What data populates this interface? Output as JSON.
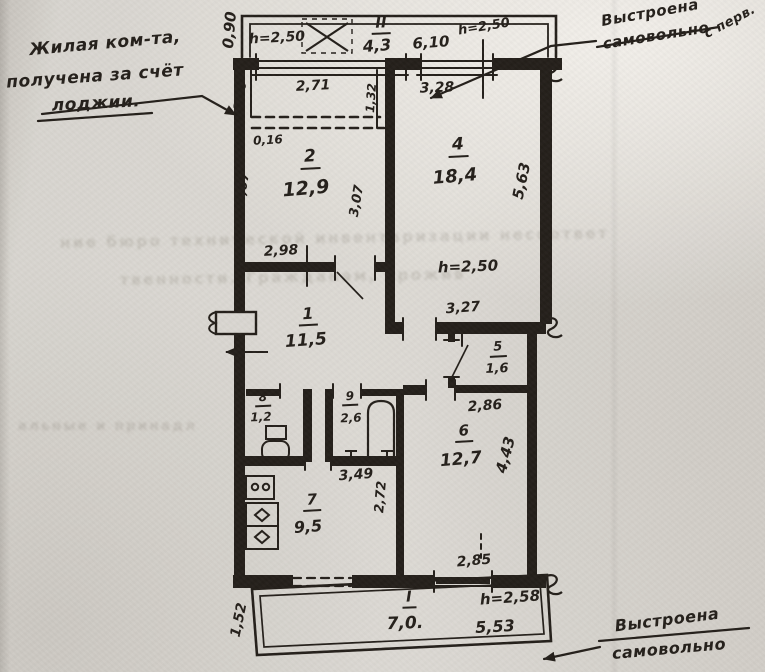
{
  "paper_color": "#dad7d1",
  "ink_color": "#241f1a",
  "rooms": [
    {
      "number": "II",
      "area": "4,3"
    },
    {
      "number": "2",
      "area": "12,9"
    },
    {
      "number": "4",
      "area": "18,4"
    },
    {
      "number": "1",
      "area": "11,5"
    },
    {
      "number": "5",
      "area": "1,6"
    },
    {
      "number": "8",
      "area": "1,2"
    },
    {
      "number": "9",
      "area": "2,6"
    },
    {
      "number": "6",
      "area": "12,7"
    },
    {
      "number": "7",
      "area": "9,5"
    },
    {
      "number": "I",
      "area": "7,0."
    }
  ],
  "labels": [
    {
      "name": "height-loggia",
      "text": "h=2,50",
      "x": 277,
      "y": 38,
      "size": 14,
      "rot": -3
    },
    {
      "name": "room-II-number",
      "text": "II",
      "x": 381,
      "y": 25,
      "size": 15,
      "rot": -2,
      "underline": true
    },
    {
      "name": "room-II-area",
      "text": "4,3",
      "x": 377,
      "y": 46,
      "size": 16,
      "rot": -4
    },
    {
      "name": "dim-6-10",
      "text": "6,10",
      "x": 431,
      "y": 43,
      "size": 15,
      "rot": -4
    },
    {
      "name": "height-loggia-right",
      "text": "h=2,50",
      "x": 484,
      "y": 27,
      "size": 13,
      "rot": -9
    },
    {
      "name": "dim-0-90",
      "text": "0,90",
      "x": 230,
      "y": 30,
      "size": 15,
      "rot": -85
    },
    {
      "name": "dim-2-71",
      "text": "2,71",
      "x": 313,
      "y": 86,
      "size": 14,
      "rot": -3
    },
    {
      "name": "dim-1-80",
      "text": "1,80",
      "x": 240,
      "y": 96,
      "size": 12,
      "rot": -80
    },
    {
      "name": "dim-1-32",
      "text": "1,32",
      "x": 371,
      "y": 98,
      "size": 12,
      "rot": -86
    },
    {
      "name": "dim-0-16",
      "text": "0,16",
      "x": 268,
      "y": 140,
      "size": 12,
      "rot": -3
    },
    {
      "name": "room-2-number",
      "text": "2",
      "x": 310,
      "y": 159,
      "size": 17,
      "rot": -3,
      "underline": true
    },
    {
      "name": "room-2-area",
      "text": "12,9",
      "x": 306,
      "y": 189,
      "size": 19,
      "rot": -5
    },
    {
      "name": "dim-3-07-left",
      "text": "3,07",
      "x": 243,
      "y": 188,
      "size": 13,
      "rot": -80
    },
    {
      "name": "dim-3-07-right",
      "text": "3,07",
      "x": 357,
      "y": 201,
      "size": 13,
      "rot": -80
    },
    {
      "name": "dim-2-98",
      "text": "2,98",
      "x": 281,
      "y": 251,
      "size": 14,
      "rot": -3
    },
    {
      "name": "dim-3-28",
      "text": "3,28",
      "x": 437,
      "y": 88,
      "size": 14,
      "rot": -2
    },
    {
      "name": "room-4-number",
      "text": "4",
      "x": 458,
      "y": 147,
      "size": 17,
      "rot": -3,
      "underline": true
    },
    {
      "name": "room-4-area",
      "text": "18,4",
      "x": 455,
      "y": 177,
      "size": 18,
      "rot": -5
    },
    {
      "name": "dim-5-63",
      "text": "5,63",
      "x": 522,
      "y": 181,
      "size": 15,
      "rot": -78
    },
    {
      "name": "height-room-4",
      "text": "h=2,50",
      "x": 468,
      "y": 267,
      "size": 15,
      "rot": -2
    },
    {
      "name": "dim-3-27",
      "text": "3,27",
      "x": 463,
      "y": 308,
      "size": 14,
      "rot": -4
    },
    {
      "name": "room-1-number",
      "text": "1",
      "x": 308,
      "y": 316,
      "size": 16,
      "rot": -3,
      "underline": true
    },
    {
      "name": "room-1-area",
      "text": "11,5",
      "x": 306,
      "y": 341,
      "size": 17,
      "rot": -4
    },
    {
      "name": "room-5-number",
      "text": "5",
      "x": 498,
      "y": 349,
      "size": 13,
      "rot": -3,
      "underline": true
    },
    {
      "name": "room-5-area",
      "text": "1,6",
      "x": 497,
      "y": 369,
      "size": 13,
      "rot": -2
    },
    {
      "name": "dim-2-86",
      "text": "2,86",
      "x": 485,
      "y": 406,
      "size": 14,
      "rot": -4
    },
    {
      "name": "room-8-number",
      "text": "8",
      "x": 263,
      "y": 399,
      "size": 12,
      "rot": -3,
      "underline": true
    },
    {
      "name": "room-8-area",
      "text": "1,2",
      "x": 261,
      "y": 417,
      "size": 12,
      "rot": -2
    },
    {
      "name": "room-9-number",
      "text": "9",
      "x": 350,
      "y": 398,
      "size": 12,
      "rot": -3,
      "underline": true
    },
    {
      "name": "room-9-area",
      "text": "2,6",
      "x": 351,
      "y": 418,
      "size": 12,
      "rot": -2
    },
    {
      "name": "dim-3-49",
      "text": "3,49",
      "x": 356,
      "y": 475,
      "size": 14,
      "rot": -4
    },
    {
      "name": "room-6-number",
      "text": "6",
      "x": 464,
      "y": 433,
      "size": 15,
      "rot": -3,
      "underline": true
    },
    {
      "name": "room-6-area",
      "text": "12,7",
      "x": 461,
      "y": 460,
      "size": 17,
      "rot": -5
    },
    {
      "name": "dim-4-43",
      "text": "4,43",
      "x": 506,
      "y": 455,
      "size": 15,
      "rot": -75
    },
    {
      "name": "dim-2-85",
      "text": "2,85",
      "x": 474,
      "y": 561,
      "size": 14,
      "rot": -5
    },
    {
      "name": "room-7-number",
      "text": "7",
      "x": 312,
      "y": 502,
      "size": 15,
      "rot": -3,
      "underline": true
    },
    {
      "name": "room-7-area",
      "text": "9,5",
      "x": 308,
      "y": 527,
      "size": 16,
      "rot": -4
    },
    {
      "name": "dim-2-72",
      "text": "2,72",
      "x": 381,
      "y": 497,
      "size": 13,
      "rot": -85
    },
    {
      "name": "room-I-number",
      "text": "I",
      "x": 409,
      "y": 599,
      "size": 15,
      "rot": -2,
      "underline": true
    },
    {
      "name": "room-I-area",
      "text": "7,0.",
      "x": 405,
      "y": 624,
      "size": 17,
      "rot": -2
    },
    {
      "name": "height-balcony",
      "text": "h=2,58",
      "x": 510,
      "y": 598,
      "size": 15,
      "rot": -4
    },
    {
      "name": "dim-5-53",
      "text": "5,53",
      "x": 495,
      "y": 627,
      "size": 16,
      "rot": -3
    },
    {
      "name": "dim-1-52",
      "text": "1,52",
      "x": 239,
      "y": 620,
      "size": 14,
      "rot": -78
    }
  ],
  "annotations": [
    {
      "name": "note-room-from-loggia",
      "lines": [
        {
          "text": "Жилая ком-та,",
          "x": 105,
          "y": 44,
          "size": 17,
          "rot": -5
        },
        {
          "text": "получена за счёт",
          "x": 95,
          "y": 77,
          "size": 17,
          "rot": -4
        },
        {
          "text": "лоджии.",
          "x": 96,
          "y": 104,
          "size": 17,
          "rot": -3
        }
      ]
    },
    {
      "name": "note-unauthorized-top",
      "lines": [
        {
          "text": "Выстроена",
          "x": 650,
          "y": 13,
          "size": 15,
          "rot": -10
        },
        {
          "text": "самовольно",
          "x": 656,
          "y": 36,
          "size": 15,
          "rot": -9
        }
      ]
    },
    {
      "name": "note-corner-fragment",
      "lines": [
        {
          "text": "с перв.",
          "x": 730,
          "y": 22,
          "size": 13,
          "rot": -28
        }
      ]
    },
    {
      "name": "note-unauthorized-bottom",
      "lines": [
        {
          "text": "Выстроена",
          "x": 667,
          "y": 620,
          "size": 16,
          "rot": -7
        },
        {
          "text": "самовольно",
          "x": 669,
          "y": 649,
          "size": 16,
          "rot": -5
        }
      ]
    }
  ],
  "showthrough": [
    {
      "name": "showthrough-line-1",
      "text": "ние бюро технической инвентаризации несоответ",
      "x": 60,
      "y": 231,
      "size": 15,
      "rot": -1
    },
    {
      "name": "showthrough-line-2",
      "text": "твенности. Гражданам, прожив",
      "x": 120,
      "y": 270,
      "size": 15,
      "rot": -1
    },
    {
      "name": "showthrough-line-3",
      "text": "альные и принадл",
      "x": 18,
      "y": 420,
      "size": 13,
      "rot": 0
    }
  ]
}
